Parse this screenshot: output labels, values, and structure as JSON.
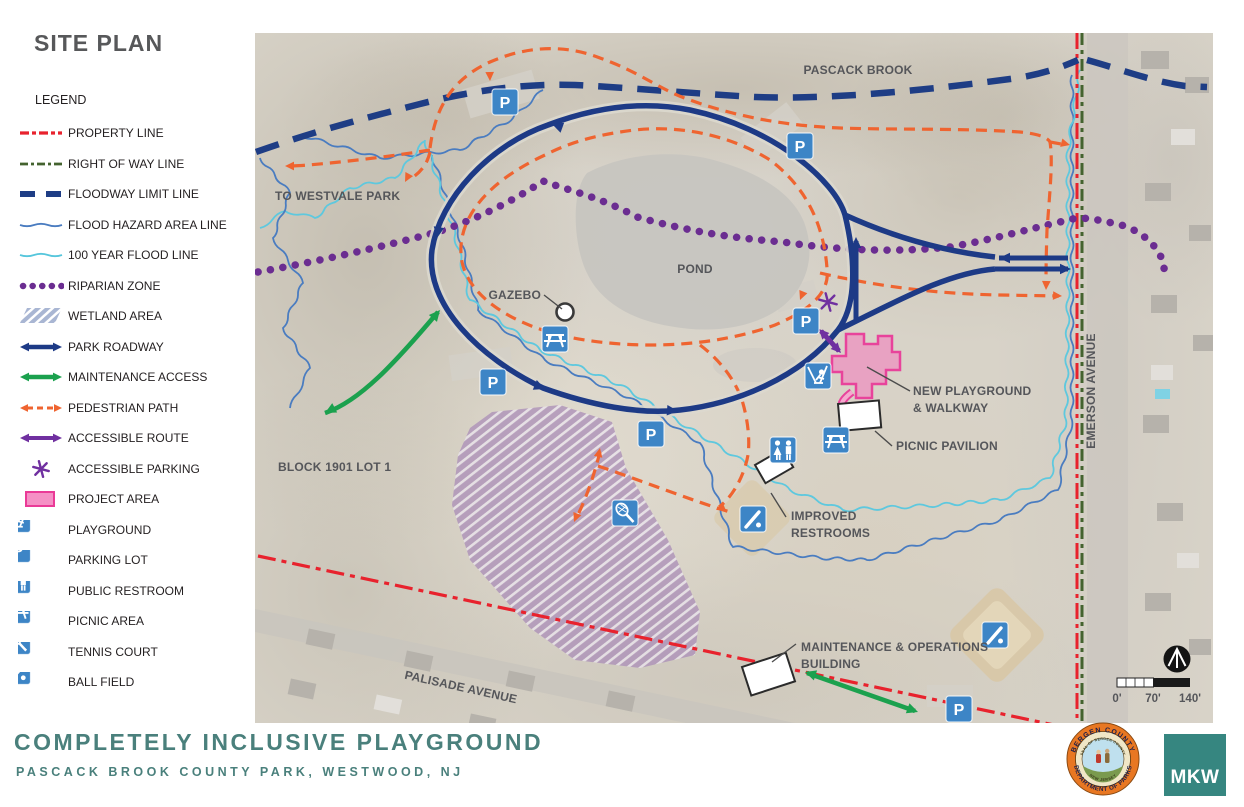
{
  "panel": {
    "title": "SITE PLAN",
    "legend_heading": "LEGEND",
    "items": [
      {
        "id": "property-line",
        "label": "PROPERTY LINE"
      },
      {
        "id": "right-of-way",
        "label": "RIGHT OF WAY LINE"
      },
      {
        "id": "floodway",
        "label": "FLOODWAY LIMIT LINE"
      },
      {
        "id": "flood-hazard",
        "label": "FLOOD HAZARD AREA LINE"
      },
      {
        "id": "flood-100",
        "label": "100 YEAR FLOOD LINE"
      },
      {
        "id": "riparian",
        "label": "RIPARIAN ZONE"
      },
      {
        "id": "wetland",
        "label": "WETLAND AREA"
      },
      {
        "id": "roadway",
        "label": "PARK ROADWAY"
      },
      {
        "id": "maintenance",
        "label": "MAINTENANCE ACCESS"
      },
      {
        "id": "pedestrian",
        "label": "PEDESTRIAN PATH"
      },
      {
        "id": "accessible-route",
        "label": "ACCESSIBLE ROUTE"
      },
      {
        "id": "accessible-parking",
        "label": "ACCESSIBLE PARKING"
      },
      {
        "id": "project-area",
        "label": "PROJECT AREA"
      },
      {
        "id": "playground",
        "label": "PLAYGROUND"
      },
      {
        "id": "parking",
        "label": "PARKING LOT"
      },
      {
        "id": "restroom",
        "label": "PUBLIC RESTROOM"
      },
      {
        "id": "picnic",
        "label": "PICNIC AREA"
      },
      {
        "id": "tennis",
        "label": "TENNIS COURT"
      },
      {
        "id": "ballfield",
        "label": "BALL FIELD"
      }
    ]
  },
  "map": {
    "parking_label": "P",
    "labels": {
      "pascack_brook": "PASCACK BROOK",
      "to_westvale": "TO WESTVALE PARK",
      "pond": "POND",
      "gazebo": "GAZEBO",
      "block": "BLOCK 1901 LOT 1",
      "new_playground_1": "NEW PLAYGROUND",
      "new_playground_2": "& WALKWAY",
      "picnic_pavilion": "PICNIC PAVILION",
      "improved_restrooms_1": "IMPROVED",
      "improved_restrooms_2": "RESTROOMS",
      "maintenance_1": "MAINTENANCE & OPERATIONS",
      "maintenance_2": "BUILDING",
      "palisade": "PALISADE AVENUE",
      "emerson": "EMERSON AVENUE"
    },
    "scale": {
      "t0": "0'",
      "t70": "70'",
      "t140": "140'"
    }
  },
  "footer": {
    "title": "COMPLETELY INCLUSIVE PLAYGROUND",
    "subtitle": "PASCACK BROOK COUNTY PARK, WESTWOOD, NJ",
    "seal_ring_top": "BERGEN COUNTY",
    "seal_ring_bottom": "DEPARTMENT OF PARKS",
    "seal_inner_top": "SEAL OF BERGEN COUNTY",
    "seal_inner_bottom": "NEW JERSEY",
    "mkw": "MKW"
  },
  "colors": {
    "property_red": "#e8222d",
    "right_of_way_green": "#44632f",
    "floodway_navy": "#1e3d85",
    "flood_hazard_blue": "#4a7cc0",
    "flood_100_cyan": "#56c6dc",
    "riparian_purple": "#6b2d91",
    "roadway_navy": "#1d3a86",
    "maintenance_green": "#1ba14e",
    "pedestrian_orange": "#ef6430",
    "accessible_purple": "#7030a0",
    "project_pink": "#f590c5",
    "icon_blue": "#3d85c6",
    "title_teal": "#4a807c"
  }
}
